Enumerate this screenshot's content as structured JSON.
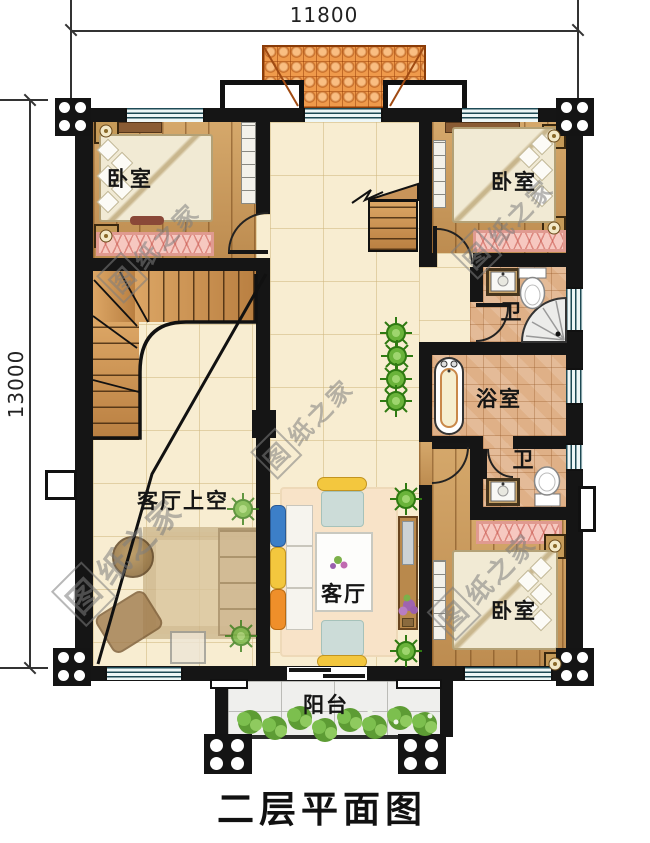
{
  "title": "二层平面图",
  "dimensions": {
    "top": "11800",
    "left": "13000"
  },
  "rooms": {
    "bedroom_tl": "卧室",
    "bedroom_tr": "卧室",
    "bedroom_br": "卧室",
    "toilet_top": "卫",
    "toilet_bottom": "卫",
    "bathroom": "浴室",
    "living_void": "客厅上空",
    "living_room": "客厅",
    "balcony": "阳台"
  },
  "watermark": {
    "logo": "图",
    "text": "纸之家"
  },
  "colors": {
    "wall": "#151515",
    "wood_floor": "#cb9a5f",
    "tile_floor": "#f8edd1",
    "bath_tile": "#dfb087",
    "roof": "#ef9a4b",
    "rug": "#f6c8c0",
    "plant": "#66b13a",
    "balcony_floor": "#efefed"
  }
}
